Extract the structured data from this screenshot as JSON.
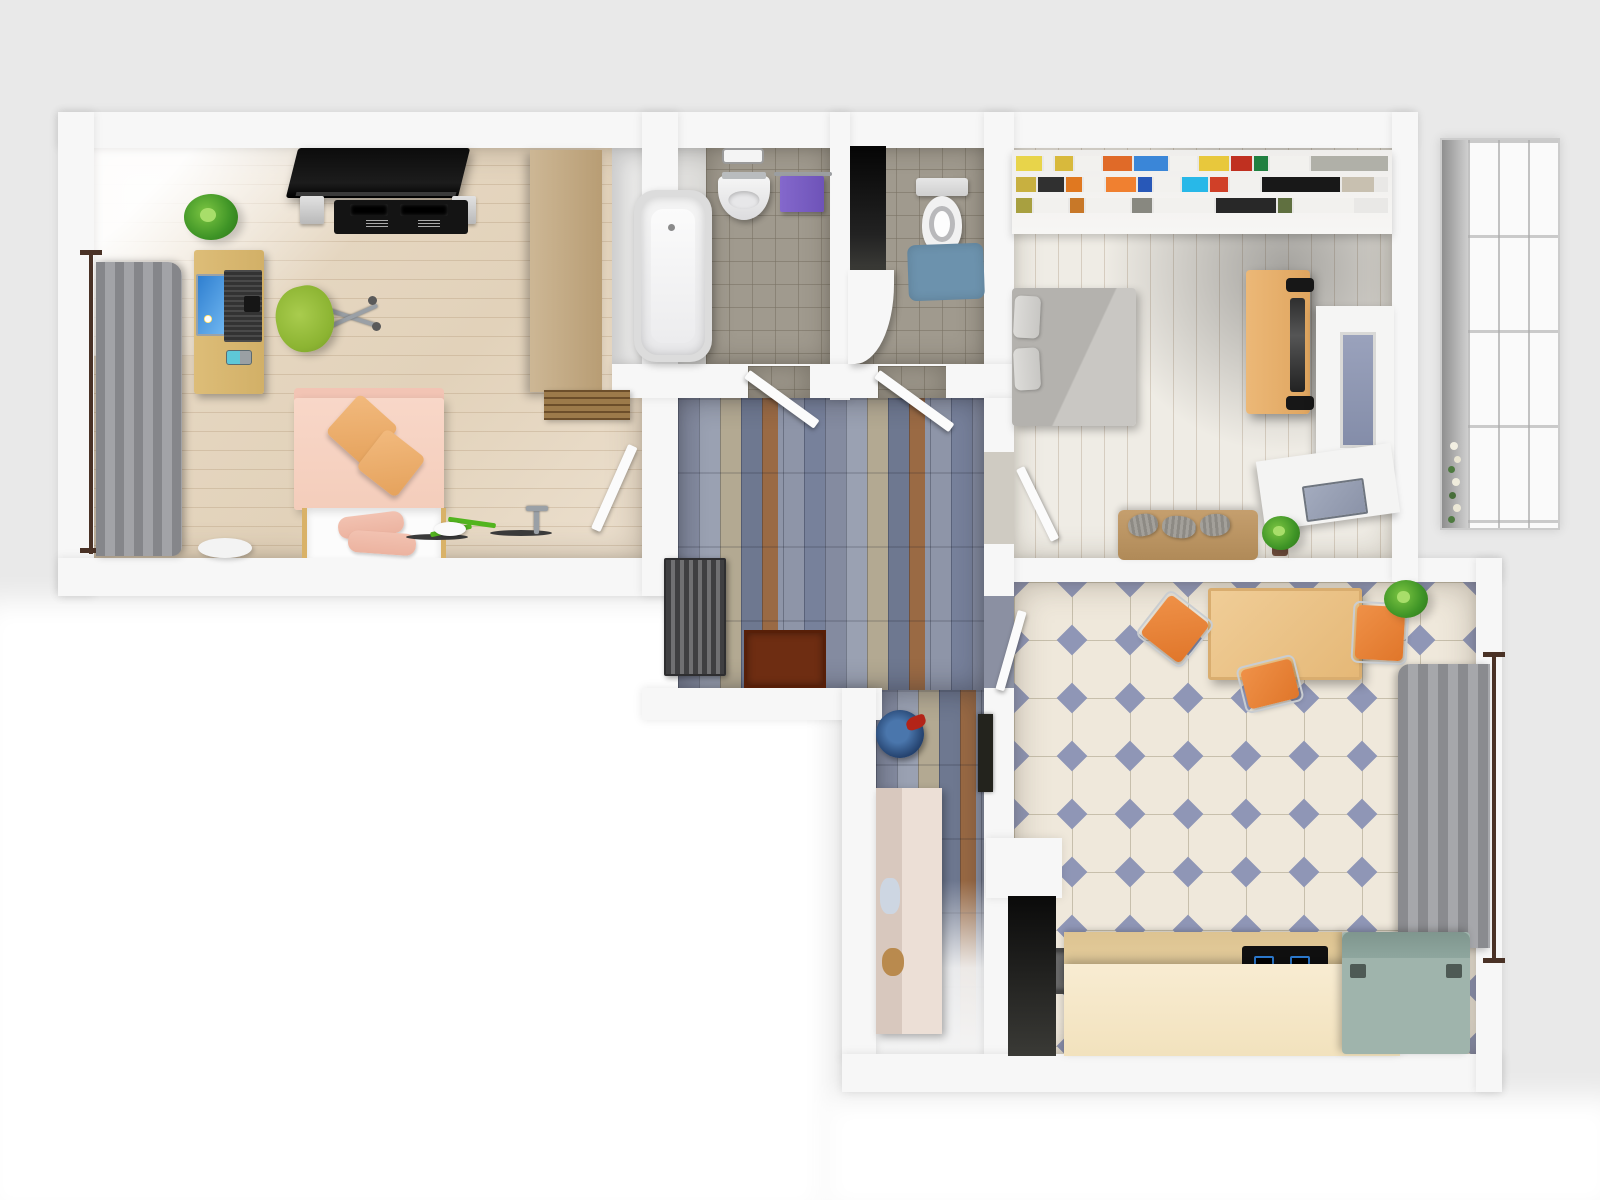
{
  "scene": {
    "type": "3d-floor-plan-render",
    "view": "top-down",
    "description": "Rendered top-down floor plan of an apartment with living room, bathroom, WC, bedroom, hallway, corridor, kitchen and glazed balcony. No text is rendered in the image."
  },
  "palette": {
    "bg": "#e9e9e9",
    "wall": "#f7f7f7",
    "bath_tile": "#a09a8e",
    "tile_diamond": "#8f96b6",
    "accent_orange": "#e0762a",
    "accent_green": "#8cb432",
    "accent_purple": "#6e53b8",
    "accent_teal": "#9fb4ac",
    "slate_blue": "#8b92a4",
    "wood_light": "#e2d2ba",
    "wood_desk": "#d2b067",
    "curtain_gray": "#95969a",
    "rug_blue": "#6c92ad",
    "mat_brown": "#6e2d12"
  },
  "rooms": [
    {
      "id": "living-room",
      "furniture": [
        "tv-panel",
        "media-console",
        "plant",
        "computer-desk",
        "monitor",
        "laptop",
        "office-chair",
        "window-curtain",
        "sofa-bed",
        "cushions",
        "pillows",
        "wardrobe",
        "step-mat",
        "bicycle",
        "stool"
      ]
    },
    {
      "id": "bathroom",
      "furniture": [
        "bathtub",
        "wash-basin",
        "towel-rail",
        "purple-towel",
        "vent-grille"
      ]
    },
    {
      "id": "wc",
      "furniture": [
        "toilet",
        "blue-rug",
        "duct-shaft"
      ]
    },
    {
      "id": "bedroom",
      "furniture": [
        "bookshelf",
        "double-bed",
        "wood-desk",
        "desk-chair",
        "wall-unit",
        "side-table",
        "laptop",
        "couch",
        "plant"
      ]
    },
    {
      "id": "hallway",
      "furniture": [
        "radiator",
        "doormat",
        "open-doors"
      ]
    },
    {
      "id": "corridor",
      "furniture": [
        "blue-bowl",
        "storage-cabinet",
        "mirror"
      ]
    },
    {
      "id": "kitchen",
      "furniture": [
        "dining-table",
        "orange-chairs",
        "plant",
        "window-curtain",
        "counter",
        "cooktop",
        "chest-appliance"
      ]
    },
    {
      "id": "balcony",
      "furniture": [
        "glazing",
        "flowers"
      ]
    }
  ],
  "bedroom_bookshelf": {
    "rows": [
      [
        {
          "c": "#e8d44a",
          "w": 26
        },
        {
          "c": "#f0efec",
          "w": 10
        },
        {
          "c": "#d8b93c",
          "w": 18
        },
        {
          "c": "#f2f1ee",
          "w": 26
        },
        {
          "c": "#e06a28",
          "w": 30
        },
        {
          "c": "#3a86d8",
          "w": 34
        },
        {
          "c": "#f2f1ee",
          "w": 28
        },
        {
          "c": "#e8c83c",
          "w": 30
        },
        {
          "c": "#c03020",
          "w": 22
        },
        {
          "c": "#208040",
          "w": 14
        },
        {
          "c": "#f2f1ee",
          "w": 40
        },
        {
          "c": "#b0b0a8",
          "w": 78
        }
      ],
      [
        {
          "c": "#c8b040",
          "w": 20
        },
        {
          "c": "#303030",
          "w": 26
        },
        {
          "c": "#e07820",
          "w": 16
        },
        {
          "c": "#f2f1ee",
          "w": 20
        },
        {
          "c": "#f08030",
          "w": 30
        },
        {
          "c": "#2858b8",
          "w": 14
        },
        {
          "c": "#f2f1ee",
          "w": 26
        },
        {
          "c": "#28b8e8",
          "w": 26
        },
        {
          "c": "#d04028",
          "w": 18
        },
        {
          "c": "#f2f1ee",
          "w": 30
        },
        {
          "c": "#181818",
          "w": 78
        },
        {
          "c": "#c8c0b0",
          "w": 32
        }
      ],
      [
        {
          "c": "#a8a040",
          "w": 16
        },
        {
          "c": "#f2f1ee",
          "w": 34
        },
        {
          "c": "#c87828",
          "w": 14
        },
        {
          "c": "#f2f1ee",
          "w": 44
        },
        {
          "c": "#888880",
          "w": 20
        },
        {
          "c": "#f2f1ee",
          "w": 60
        },
        {
          "c": "#282828",
          "w": 60
        },
        {
          "c": "#607040",
          "w": 14
        },
        {
          "c": "#f2f1ee",
          "w": 60
        }
      ]
    ]
  }
}
